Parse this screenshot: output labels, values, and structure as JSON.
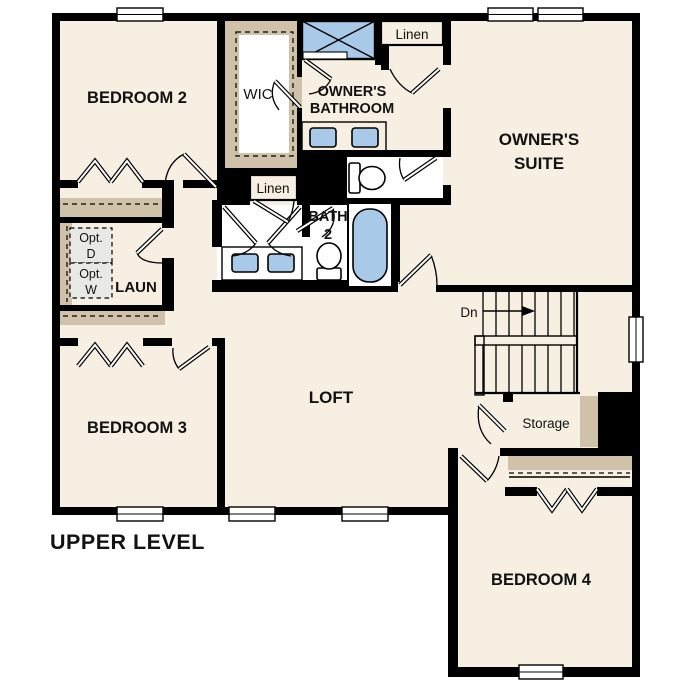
{
  "title": "UPPER LEVEL",
  "labels": {
    "bedroom2": "BEDROOM 2",
    "bedroom3": "BEDROOM 3",
    "bedroom4": "BEDROOM 4",
    "loft": "LOFT",
    "wic": "WIC",
    "owners_bath_1": "OWNER'S",
    "owners_bath_2": "BATHROOM",
    "owners_suite_1": "OWNER'S",
    "owners_suite_2": "SUITE",
    "linen_top": "Linen",
    "linen_hall": "Linen",
    "bath2_1": "BATH",
    "bath2_2": "2",
    "laundry": "LAUN",
    "opt_d_1": "Opt.",
    "opt_d_2": "D",
    "opt_w_1": "Opt.",
    "opt_w_2": "W",
    "down": "Dn",
    "storage": "Storage"
  },
  "colors": {
    "floor": "#f7efe2",
    "wall": "#000000",
    "tan": "#cfc2a8",
    "blue": "#a9c9e9",
    "optbox": "#e8e8e4"
  }
}
